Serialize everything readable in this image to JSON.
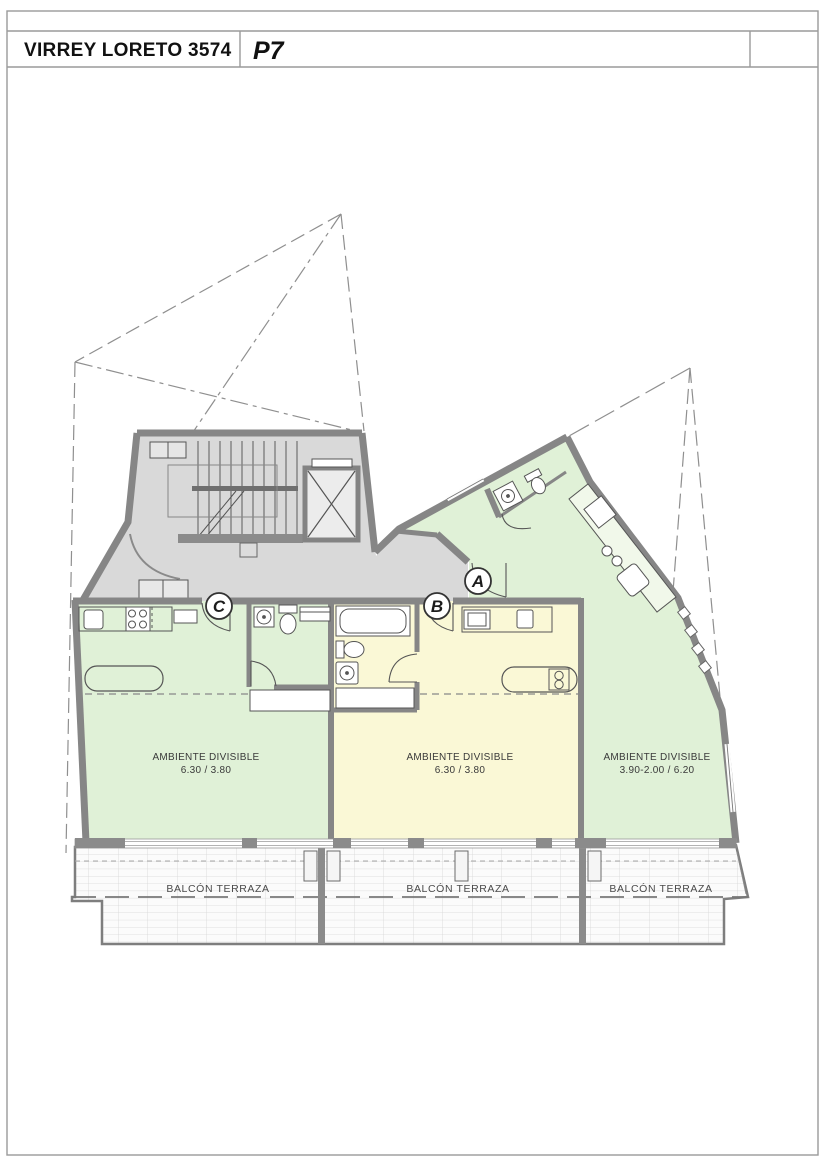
{
  "title_block": {
    "address": "VIRREY LORETO 3574",
    "floor_label": "P7"
  },
  "units": [
    {
      "id": "C",
      "room": "AMBIENTE DIVISIBLE",
      "dims": "6.30 / 3.80"
    },
    {
      "id": "B",
      "room": "AMBIENTE DIVISIBLE",
      "dims": "6.30 / 3.80"
    },
    {
      "id": "A",
      "room": "AMBIENTE DIVISIBLE",
      "dims": "3.90-2.00 / 6.20"
    }
  ],
  "balcony": {
    "labels": [
      "BALCÓN TERRAZA",
      "BALCÓN TERRAZA",
      "BALCÓN TERRAZA"
    ]
  },
  "colors": {
    "unit_green": "#e0f1d7",
    "unit_yellow": "#faf8d6",
    "common_gray": "#d9d9d9",
    "wall": "#868686",
    "balcony_bg": "#fbfbfb"
  }
}
